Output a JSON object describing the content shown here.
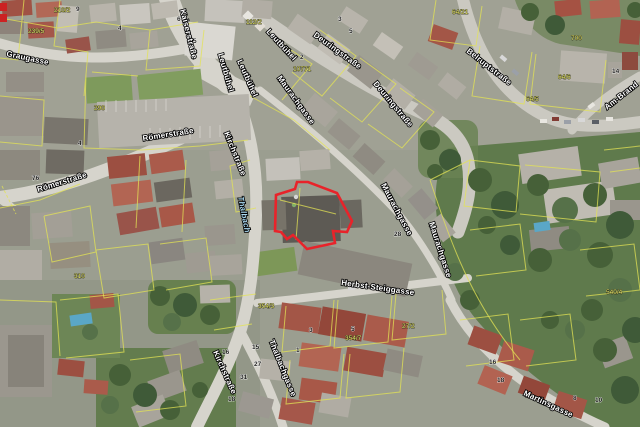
{
  "map": {
    "type": "aerial-orthophoto-with-cadastre",
    "region": "town center",
    "street_labels": [
      {
        "id": "label-kaiserstrasse",
        "text": "Kaiserstraße",
        "x": 180,
        "y": 10,
        "rot": 76
      },
      {
        "id": "label-graugasse",
        "text": "Graugasse",
        "x": 6,
        "y": 56,
        "rot": 12
      },
      {
        "id": "label-leutbuehel-1",
        "text": "Leutbühel",
        "x": 266,
        "y": 32,
        "rot": 47
      },
      {
        "id": "label-leutbuehel-2",
        "text": "Leutbühel",
        "x": 237,
        "y": 61,
        "rot": 66
      },
      {
        "id": "label-leutbuehel-3",
        "text": "Leutbühel",
        "x": 218,
        "y": 54,
        "rot": 74
      },
      {
        "id": "label-deuringstrasse-1",
        "text": "Deuringstraße",
        "x": 313,
        "y": 36,
        "rot": 36
      },
      {
        "id": "label-deuringstrasse-2",
        "text": "Deuringstraße",
        "x": 373,
        "y": 84,
        "rot": 50
      },
      {
        "id": "label-maurachgasse-1",
        "text": "Maurachgasse",
        "x": 277,
        "y": 78,
        "rot": 54
      },
      {
        "id": "label-maurachgasse-2",
        "text": "Maurachgasse",
        "x": 381,
        "y": 185,
        "rot": 62
      },
      {
        "id": "label-maurachgasse-3",
        "text": "Maurachgasse",
        "x": 429,
        "y": 223,
        "rot": 72
      },
      {
        "id": "label-belruptstrasse",
        "text": "Belruptstraße",
        "x": 466,
        "y": 52,
        "rot": 38
      },
      {
        "id": "label-am-brand",
        "text": "Am-Brand",
        "x": 607,
        "y": 110,
        "rot": -38
      },
      {
        "id": "label-kirchstrasse-1",
        "text": "Kirchstraße",
        "x": 224,
        "y": 133,
        "rot": 68
      },
      {
        "id": "label-roemerstrasse-1",
        "text": "Römerstraße",
        "x": 143,
        "y": 141,
        "rot": -9
      },
      {
        "id": "label-roemerstrasse-2",
        "text": "Römerstraße",
        "x": 38,
        "y": 192,
        "rot": -17
      },
      {
        "id": "label-montfortstrasse",
        "text": "Montfortstraße",
        "x": -30,
        "y": 178,
        "rot": 72
      },
      {
        "id": "label-thalbach",
        "text": "Thalbach",
        "x": 238,
        "y": 197,
        "rot": 79,
        "type": "stream"
      },
      {
        "id": "label-herbst-steiggasse",
        "text": "Herbst-Steiggasse",
        "x": 341,
        "y": 285,
        "rot": 8
      },
      {
        "id": "label-thalbachgasse",
        "text": "Thalbachgasse",
        "x": 269,
        "y": 341,
        "rot": 68
      },
      {
        "id": "label-kirchstrasse-2",
        "text": "Kirchstraße",
        "x": 213,
        "y": 352,
        "rot": 66
      },
      {
        "id": "label-martinsgasse",
        "text": "Martinsgasse",
        "x": 523,
        "y": 395,
        "rot": 25
      }
    ],
    "parcel_numbers": [
      {
        "text": "210/2",
        "x": 54,
        "y": 12
      },
      {
        "text": "239/5",
        "x": 28,
        "y": 33
      },
      {
        "text": "112/2",
        "x": 246,
        "y": 24
      },
      {
        "text": "290",
        "x": 94,
        "y": 110
      },
      {
        "text": "10771",
        "x": 293,
        "y": 71
      },
      {
        "text": "700",
        "x": 571,
        "y": 40
      },
      {
        "text": "64/21",
        "x": 452,
        "y": 14
      },
      {
        "text": "64/6",
        "x": 558,
        "y": 79
      },
      {
        "text": "64/5",
        "x": 526,
        "y": 101
      },
      {
        "text": "310",
        "x": 74,
        "y": 278
      },
      {
        "text": "354/3",
        "x": 258,
        "y": 308
      },
      {
        "text": "354/7",
        "x": 345,
        "y": 340
      },
      {
        "text": "27/2",
        "x": 402,
        "y": 328
      },
      {
        "text": "540/4",
        "x": 606,
        "y": 294
      }
    ],
    "house_numbers": [
      {
        "text": "9",
        "x": 76,
        "y": 11
      },
      {
        "text": "4",
        "x": 118,
        "y": 30
      },
      {
        "text": "6",
        "x": 177,
        "y": 21
      },
      {
        "text": "5",
        "x": 193,
        "y": 43
      },
      {
        "text": "3",
        "x": 194,
        "y": 54
      },
      {
        "text": "4",
        "x": 78,
        "y": 145
      },
      {
        "text": "3",
        "x": 338,
        "y": 21
      },
      {
        "text": "5",
        "x": 349,
        "y": 33
      },
      {
        "text": "2",
        "x": 300,
        "y": 59
      },
      {
        "text": "76",
        "x": 32,
        "y": 180
      },
      {
        "text": "28",
        "x": 394,
        "y": 236
      },
      {
        "text": "14",
        "x": 612,
        "y": 73
      },
      {
        "text": "16",
        "x": 222,
        "y": 354
      },
      {
        "text": "15",
        "x": 252,
        "y": 349
      },
      {
        "text": "27",
        "x": 254,
        "y": 366
      },
      {
        "text": "31",
        "x": 240,
        "y": 379
      },
      {
        "text": "18",
        "x": 228,
        "y": 401
      },
      {
        "text": "1",
        "x": 296,
        "y": 352
      },
      {
        "text": "3",
        "x": 309,
        "y": 332
      },
      {
        "text": "5",
        "x": 351,
        "y": 331
      },
      {
        "text": "16",
        "x": 489,
        "y": 364
      },
      {
        "text": "18",
        "x": 497,
        "y": 382
      },
      {
        "text": "8",
        "x": 573,
        "y": 400
      },
      {
        "text": "10",
        "x": 595,
        "y": 402
      }
    ],
    "highlight": {
      "points": "275,231 276,195 295,189 297,182 308,182 337,193 352,221 347,232 333,231 335,243 307,249 293,235 287,239 281,232",
      "stroke": "#e8232a",
      "stroke_width": 2.6
    },
    "colors": {
      "highlight": "#e8232a",
      "parcel_line": "#e3e354",
      "parcel_number": "#eaea6e",
      "street_label": "#ffffff",
      "street_label_halo": "#000000",
      "stream_label": "#a9d8f0",
      "road": "#d6d4cc",
      "vegetation": "#5f7a4c"
    }
  }
}
